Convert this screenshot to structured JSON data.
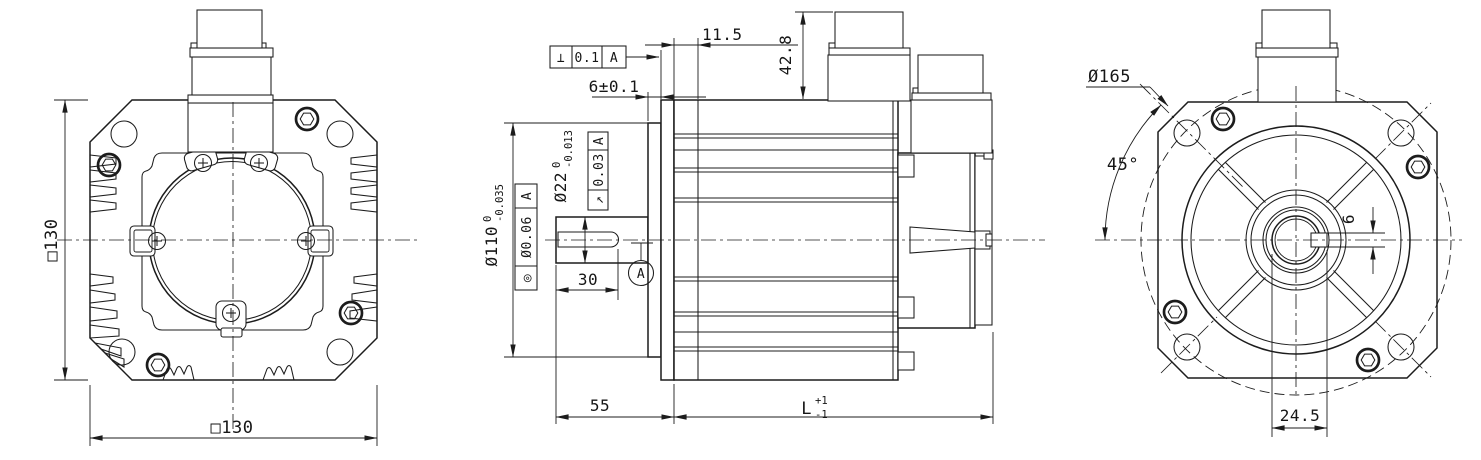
{
  "drawing": {
    "background": "#ffffff",
    "line_color": "#1c1c1c",
    "type": "servo-motor-outline-drawing"
  },
  "rear_view": {
    "height_dim": "□130",
    "width_dim": "□130"
  },
  "side_view": {
    "perpendicularity_frame": {
      "symbol": "⊥",
      "tolerance": "0.1",
      "datum": "A"
    },
    "front_cover_depth": "11.5",
    "spigot_depth": "6±0.1",
    "connector_height": "42.8",
    "pilot_diameter": {
      "main": "Ø110",
      "upper": "0",
      "lower": "-0.035"
    },
    "concentricity_frame": {
      "symbol": "◎",
      "tolerance": "Ø0.06",
      "datum": "A"
    },
    "shaft_diameter": {
      "main": "Ø22",
      "upper": "0",
      "lower": "-0.013"
    },
    "runout_frame": {
      "symbol": "↗",
      "tolerance": "0.03",
      "datum": "A"
    },
    "keyway_length": "30",
    "datum_label": "A",
    "shaft_length": "55",
    "body_length": {
      "main": "L",
      "upper": "+1",
      "lower": "-1"
    }
  },
  "front_view": {
    "bolt_circle_diameter": "Ø165",
    "bolt_angle": "45°",
    "keyway_width": "6",
    "shaft_to_key_top": "24.5"
  }
}
